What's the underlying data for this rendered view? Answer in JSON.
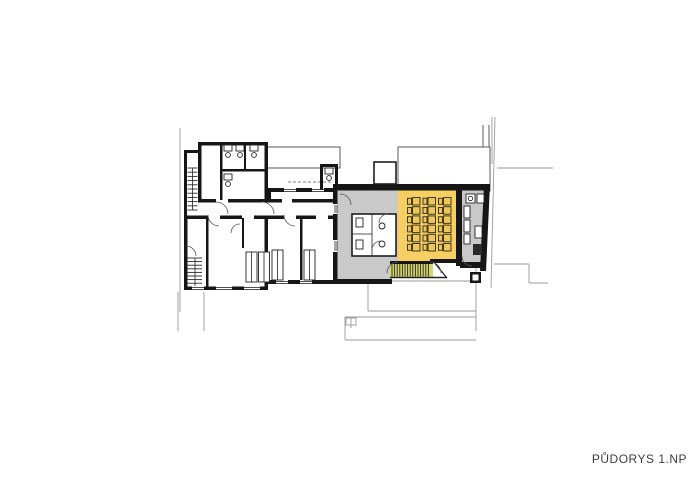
{
  "caption": {
    "text": "PŮDORYS 1.NP"
  },
  "colors": {
    "background": "#ffffff",
    "wall": "#161616",
    "hall_gray": "#c9c9c9",
    "highlight_yellow": "#f6ce62",
    "stair_tint": "#d3d66c",
    "desk_outline": "#3f3a20",
    "desk_fill": "#eec659",
    "site_line": "#9a9a9a",
    "neighbor_line": "#5a5a5a",
    "caption_color": "#3d3d3d"
  },
  "classroom": {
    "desk_rows": 6,
    "desk_groups": 3
  }
}
